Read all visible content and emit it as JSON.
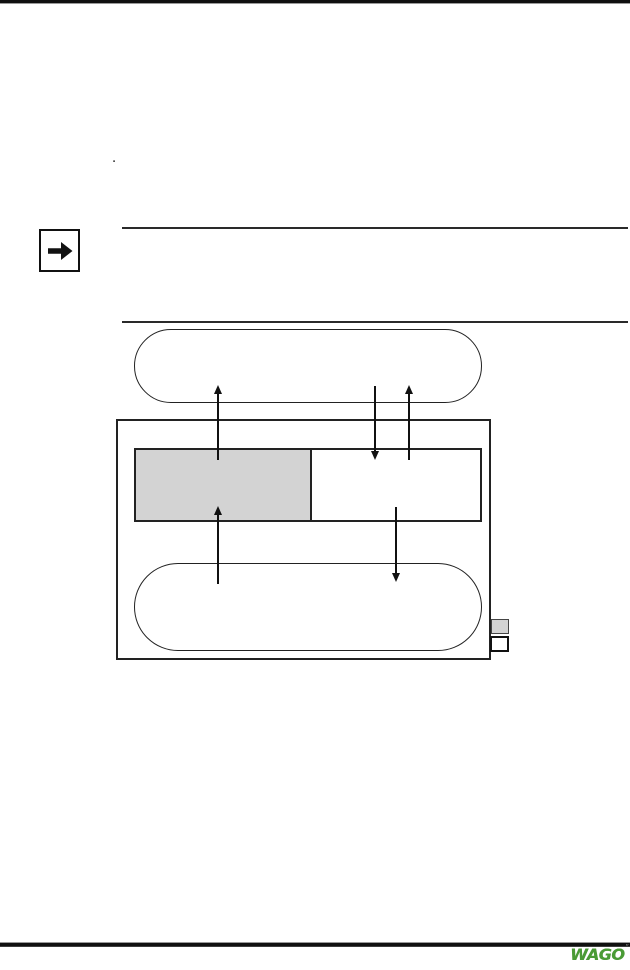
{
  "content": {
    "bullet_dot": "."
  },
  "note": {
    "icon": "arrow-right-icon"
  },
  "diagram": {
    "line_color": "#1a1a1a",
    "fill_gray": "#d3d3d3",
    "shapes": [
      {
        "name": "top-stadium",
        "type": "stadium",
        "fill": "#ffffff"
      },
      {
        "name": "outer-rect",
        "type": "rectangle",
        "fill": "#ffffff"
      },
      {
        "name": "split-box-left",
        "type": "rectangle",
        "fill": "#d3d3d3"
      },
      {
        "name": "split-box-right",
        "type": "rectangle",
        "fill": "#ffffff"
      },
      {
        "name": "bottom-stadium",
        "type": "stadium",
        "fill": "#ffffff"
      },
      {
        "name": "legend-gray-square",
        "type": "square",
        "fill": "#d3d3d3"
      },
      {
        "name": "legend-white-square",
        "type": "square",
        "fill": "#ffffff"
      }
    ],
    "arrows": [
      {
        "direction": "up",
        "x": 218,
        "tail_y": 460,
        "tip_y": 385
      },
      {
        "direction": "down",
        "x": 375,
        "tail_y": 386,
        "tip_y": 460
      },
      {
        "direction": "up",
        "x": 409,
        "tail_y": 460,
        "tip_y": 385
      },
      {
        "direction": "up",
        "x": 218,
        "tail_y": 584,
        "tip_y": 506
      },
      {
        "direction": "down",
        "x": 396,
        "tail_y": 507,
        "tip_y": 582
      }
    ]
  },
  "footer": {
    "brand": "WAGO",
    "brand_color": "#4a9b35",
    "trademark": "”"
  }
}
